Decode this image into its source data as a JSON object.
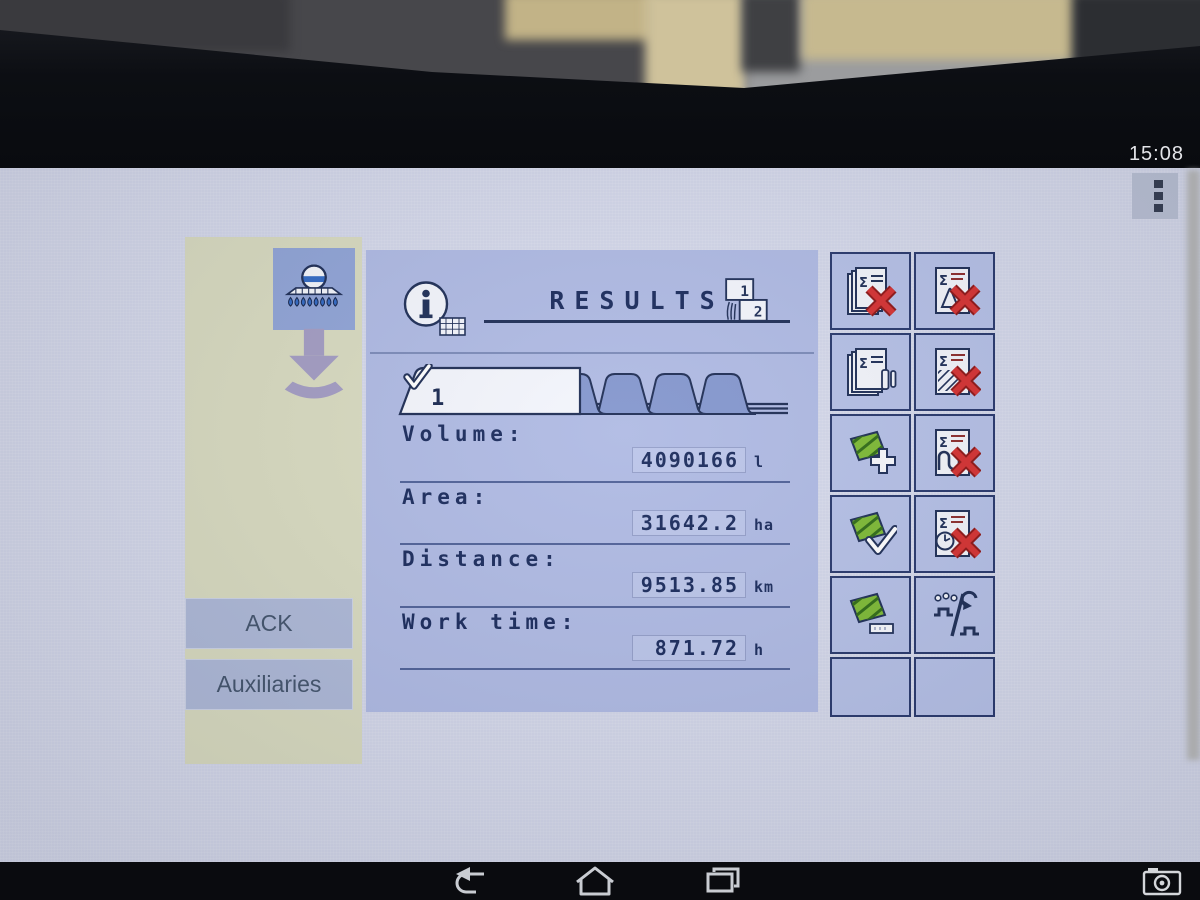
{
  "status": {
    "time": "15:08"
  },
  "app_menu": {
    "icon": "app-grid-menu-icon"
  },
  "glyphs": {
    "sigma": "Σ"
  },
  "left_panel": {
    "implement_icon": "sprayer-icon",
    "load_icon": "download-arrow-icon",
    "buttons": {
      "ack": "ACK",
      "auxiliaries": "Auxiliaries"
    }
  },
  "results": {
    "title": "RESULTS",
    "page_indicator": {
      "page1": "1",
      "page2": "2"
    },
    "counter_tab": {
      "number": "1",
      "state": "selected"
    },
    "inactive_tab_count": 4,
    "rows": [
      {
        "label": "Volume:",
        "value": "4090166",
        "unit": "l"
      },
      {
        "label": "Area:",
        "value": "31642.2",
        "unit": "ha"
      },
      {
        "label": "Distance:",
        "value": "9513.85",
        "unit": "km"
      },
      {
        "label": "Work time:",
        "value": "871.72",
        "unit": "h"
      }
    ]
  },
  "softkeys": [
    {
      "name": "reset-total-counters",
      "icon": "pages-sigma-red-x-icon"
    },
    {
      "name": "reset-volume-counter",
      "icon": "page-sigma-volume-red-x-icon"
    },
    {
      "name": "counter-stack",
      "icon": "pages-sigma-pause-icon"
    },
    {
      "name": "reset-area-counter",
      "icon": "page-sigma-area-red-x-icon"
    },
    {
      "name": "add-field",
      "icon": "field-plus-icon"
    },
    {
      "name": "reset-distance-counter",
      "icon": "page-sigma-track-red-x-icon"
    },
    {
      "name": "confirm-field",
      "icon": "field-check-icon"
    },
    {
      "name": "reset-worktime-counter",
      "icon": "page-sigma-clock-red-x-icon"
    },
    {
      "name": "field-label",
      "icon": "field-tag-icon"
    },
    {
      "name": "section-mode-toggle",
      "icon": "nozzle-mode-toggle-icon"
    },
    {
      "name": "empty",
      "icon": ""
    },
    {
      "name": "empty",
      "icon": ""
    }
  ],
  "nav_bar": {
    "back_icon": "back-icon",
    "home_icon": "home-icon",
    "recents_icon": "recents-icon",
    "camera_icon": "camera-icon"
  },
  "colors": {
    "panel_blue": "#aeb9e3",
    "softkey_blue": "#b4bfe6",
    "border_navy": "#26366b",
    "text_navy": "#17285a",
    "beige_panel": "#d8dabf",
    "accent_red": "#d52f2f",
    "accent_green": "#7cb932"
  }
}
